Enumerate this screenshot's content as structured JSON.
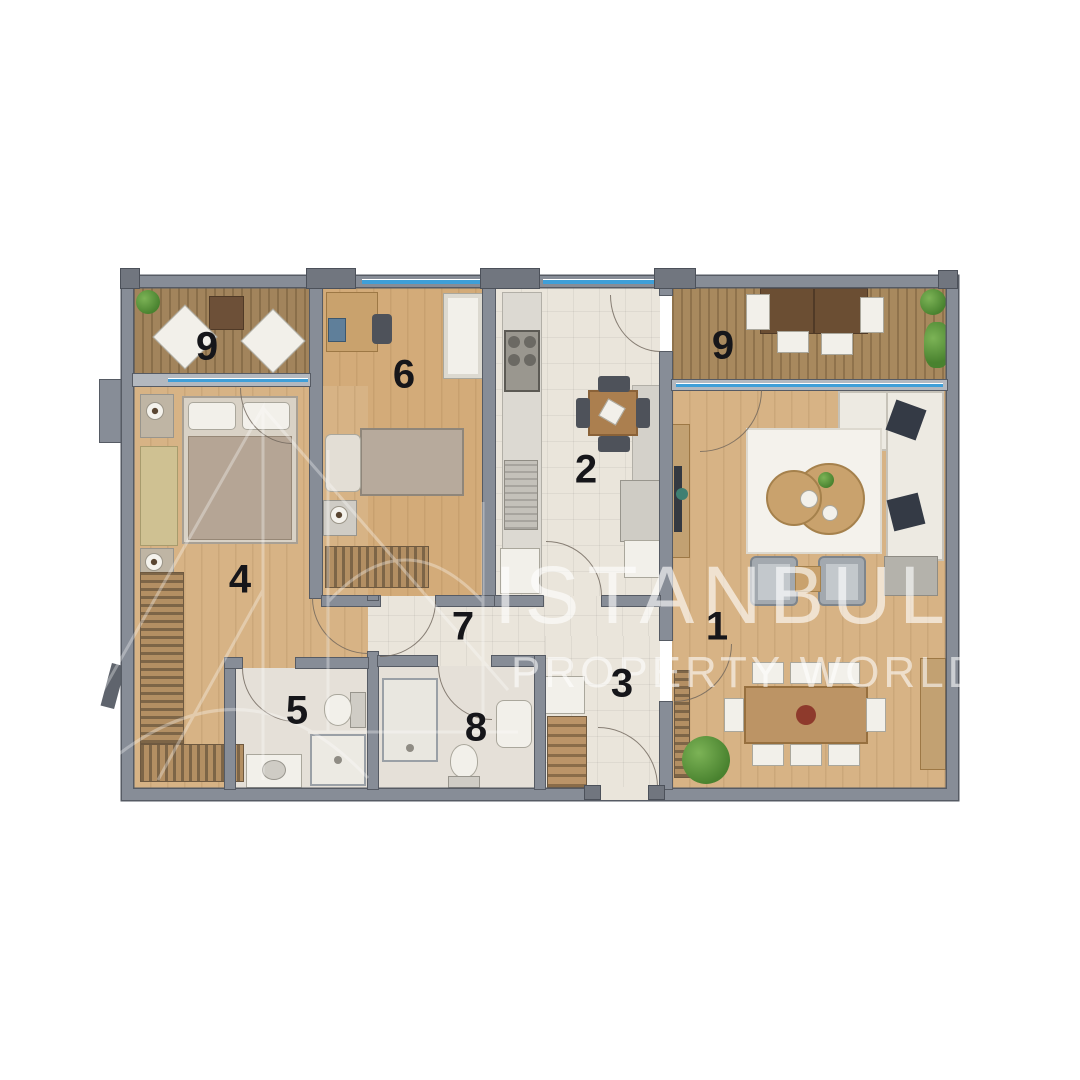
{
  "plan": {
    "room_labels": [
      {
        "id": "balcony-left",
        "number": "9"
      },
      {
        "id": "bedroom-child",
        "number": "6"
      },
      {
        "id": "kitchen",
        "number": "2"
      },
      {
        "id": "balcony-right",
        "number": "9"
      },
      {
        "id": "living-room",
        "number": "1"
      },
      {
        "id": "bedroom-master",
        "number": "4"
      },
      {
        "id": "hallway",
        "number": "7"
      },
      {
        "id": "entry-hall",
        "number": "3"
      },
      {
        "id": "bathroom-ensuite",
        "number": "5"
      },
      {
        "id": "bathroom",
        "number": "8"
      }
    ]
  },
  "watermark": {
    "title": "ISTANBUL",
    "subtitle": "PROPERTY WORLD"
  },
  "colors": {
    "wall": "#878d97",
    "wallDark": "#565b64",
    "glassWall": "#b3b8bf",
    "glazing": "#3f9fd8",
    "woodLight": "#d7b385",
    "woodRoom6": "#d3ab79",
    "balconyWood": "#a2845c",
    "balconyWoodR": "#a8895e",
    "tile": "#eae5db",
    "bath": "#e5e0d8",
    "label": "#16161a"
  }
}
